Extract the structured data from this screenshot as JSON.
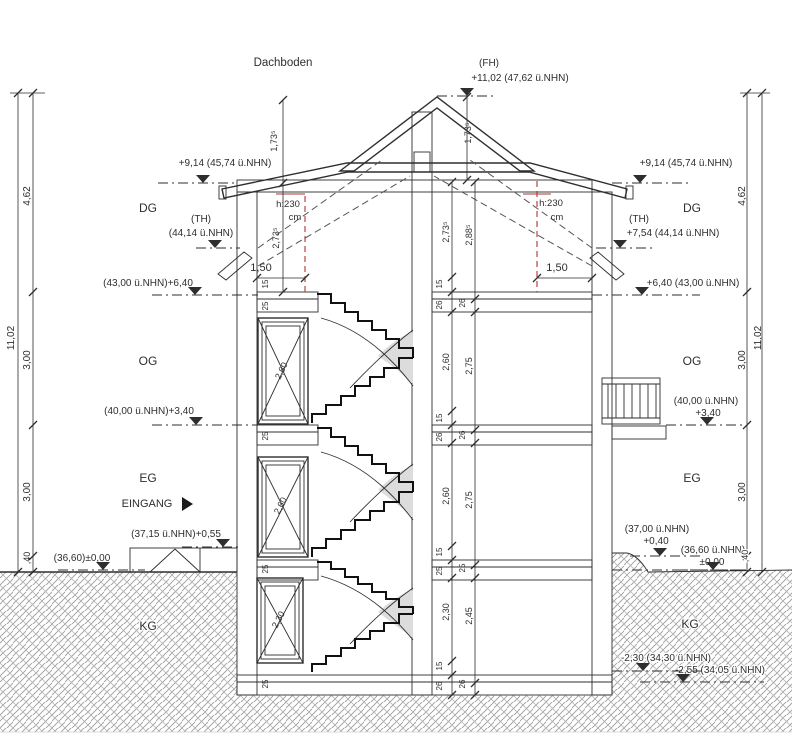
{
  "drawing_title": "Dachboden",
  "colors": {
    "line": "#2e2e2e",
    "red": "#ad3530",
    "stair_shade": "#dcdcdc",
    "hatch": "#909090"
  },
  "story_labels": [
    "DG",
    "OG",
    "EG",
    "KG"
  ],
  "labels": [
    {
      "name": "attic-title",
      "text": "Dachboden",
      "x": 283,
      "y": 66,
      "size": 11.5
    },
    {
      "name": "ridge-fh-tag",
      "text": "(FH)",
      "x": 489,
      "y": 66,
      "size": 10
    },
    {
      "name": "ridge-fh-value",
      "text": "+11,02 (47,62 ü.NHN)",
      "x": 520,
      "y": 81,
      "size": 10
    },
    {
      "name": "eaves-level-left",
      "text": "+9,14 (45,74 ü.NHN)",
      "x": 225,
      "y": 166,
      "size": 10
    },
    {
      "name": "eaves-level-right",
      "text": "+9,14 (45,74 ü.NHN)",
      "x": 686,
      "y": 166,
      "size": 10
    },
    {
      "name": "story-dg-left",
      "text": "DG",
      "x": 148,
      "y": 212,
      "size": 12
    },
    {
      "name": "story-dg-right",
      "text": "DG",
      "x": 692,
      "y": 212,
      "size": 12
    },
    {
      "name": "th-tag-left",
      "text": "(TH)",
      "x": 201,
      "y": 222,
      "size": 10
    },
    {
      "name": "th-value-left",
      "text": "(44,14 ü.NHN)",
      "x": 201,
      "y": 236,
      "size": 10
    },
    {
      "name": "th-tag-right",
      "text": "(TH)",
      "x": 639,
      "y": 222,
      "size": 10
    },
    {
      "name": "th-value-right",
      "text": "+7,54 (44,14 ü.NHN)",
      "x": 673,
      "y": 236,
      "size": 10
    },
    {
      "name": "level-640-left",
      "text": "(43,00 ü.NHN)+6,40",
      "x": 148,
      "y": 286,
      "size": 10
    },
    {
      "name": "level-640-right",
      "text": "+6,40 (43,00 ü.NHN)",
      "x": 693,
      "y": 286,
      "size": 10
    },
    {
      "name": "dim-150-left",
      "text": "1,50",
      "x": 261,
      "y": 271,
      "size": 11
    },
    {
      "name": "dim-150-right",
      "text": "1,50",
      "x": 557,
      "y": 271,
      "size": 11
    },
    {
      "name": "headroom-left-1",
      "text": "h:230",
      "x": 288,
      "y": 207,
      "size": 9.5,
      "color": "red"
    },
    {
      "name": "headroom-left-2",
      "text": "cm",
      "x": 295,
      "y": 220,
      "size": 9.5,
      "color": "red"
    },
    {
      "name": "headroom-right-1",
      "text": "h:230",
      "x": 551,
      "y": 206,
      "size": 9.5,
      "color": "red"
    },
    {
      "name": "headroom-right-2",
      "text": "cm",
      "x": 557,
      "y": 220,
      "size": 9.5,
      "color": "red"
    },
    {
      "name": "story-og-left",
      "text": "OG",
      "x": 148,
      "y": 365,
      "size": 12
    },
    {
      "name": "story-og-right",
      "text": "OG",
      "x": 692,
      "y": 365,
      "size": 12
    },
    {
      "name": "level-340-left",
      "text": "(40,00 ü.NHN)+3,40",
      "x": 149,
      "y": 414,
      "size": 10
    },
    {
      "name": "level-340-right-1",
      "text": "(40,00 ü.NHN)",
      "x": 706,
      "y": 404,
      "size": 10
    },
    {
      "name": "level-340-right-2",
      "text": "+3,40",
      "x": 708,
      "y": 416,
      "size": 10
    },
    {
      "name": "story-eg-left",
      "text": "EG",
      "x": 148,
      "y": 482,
      "size": 12
    },
    {
      "name": "story-eg-right",
      "text": "EG",
      "x": 692,
      "y": 482,
      "size": 12
    },
    {
      "name": "entrance-label",
      "text": "EINGANG",
      "x": 147,
      "y": 507,
      "size": 11
    },
    {
      "name": "level-055",
      "text": "(37,15 ü.NHN)+0,55",
      "x": 176,
      "y": 537,
      "size": 10
    },
    {
      "name": "level-000-left",
      "text": "(36,60)±0,00",
      "x": 82,
      "y": 561,
      "size": 10
    },
    {
      "name": "level-040-right-1",
      "text": "(37,00 ü.NHN)",
      "x": 657,
      "y": 532,
      "size": 10
    },
    {
      "name": "level-040-right-2",
      "text": "+0,40",
      "x": 656,
      "y": 544,
      "size": 10
    },
    {
      "name": "level-000-right-1",
      "text": "(36,60 ü.NHN)",
      "x": 713,
      "y": 553,
      "size": 10,
      "halo": true
    },
    {
      "name": "level-000-right-2",
      "text": "±0,00",
      "x": 712,
      "y": 565,
      "size": 10,
      "halo": true
    },
    {
      "name": "story-kg-left",
      "text": "KG",
      "x": 148,
      "y": 630,
      "size": 12,
      "halo": true
    },
    {
      "name": "story-kg-right",
      "text": "KG",
      "x": 690,
      "y": 628,
      "size": 12,
      "halo": true
    },
    {
      "name": "level-230-kg",
      "text": "-2,30 (34,30 ü.NHN)",
      "x": 666,
      "y": 661,
      "size": 10,
      "halo": true
    },
    {
      "name": "level-255-kg",
      "text": "-2,55 (34,05 ü.NHN)",
      "x": 720,
      "y": 673,
      "size": 10,
      "halo": true
    },
    {
      "name": "dim-total-left",
      "text": "11,02",
      "x": 14,
      "y": 338,
      "size": 10,
      "rot": -90
    },
    {
      "name": "dim-462-left",
      "text": "4,62",
      "x": 30,
      "y": 196,
      "size": 10,
      "rot": -90
    },
    {
      "name": "dim-300-left-og",
      "text": "3,00",
      "x": 30,
      "y": 360,
      "size": 10,
      "rot": -90
    },
    {
      "name": "dim-300-left-eg",
      "text": "3,00",
      "x": 30,
      "y": 492,
      "size": 10,
      "rot": -90
    },
    {
      "name": "dim-40-left",
      "text": ",40",
      "x": 30,
      "y": 558,
      "size": 9,
      "rot": -90
    },
    {
      "name": "dim-total-right",
      "text": "11,02",
      "x": 761,
      "y": 338,
      "size": 10,
      "rot": -90
    },
    {
      "name": "dim-462-right",
      "text": "4,62",
      "x": 745,
      "y": 196,
      "size": 10,
      "rot": -90
    },
    {
      "name": "dim-300-right-og",
      "text": "3,00",
      "x": 745,
      "y": 360,
      "size": 10,
      "rot": -90
    },
    {
      "name": "dim-300-right-eg",
      "text": "3,00",
      "x": 745,
      "y": 492,
      "size": 10,
      "rot": -90
    },
    {
      "name": "dim-40-right",
      "text": ",40",
      "x": 748,
      "y": 556,
      "size": 9,
      "rot": -90,
      "halo": true
    },
    {
      "name": "dim-173-left",
      "text": "1,73⁵",
      "x": 277,
      "y": 141,
      "size": 9,
      "rot": -90
    },
    {
      "name": "dim-173-right",
      "text": "1,73⁵",
      "x": 471,
      "y": 133,
      "size": 9,
      "rot": -90
    },
    {
      "name": "dim-273-left",
      "text": "2,73⁵",
      "x": 279,
      "y": 238,
      "size": 9,
      "rot": -90
    },
    {
      "name": "dim-273-mid",
      "text": "2,73⁵",
      "x": 449,
      "y": 232,
      "size": 9,
      "rot": -90
    },
    {
      "name": "dim-288-mid",
      "text": "2,88⁵",
      "x": 472,
      "y": 235,
      "size": 9,
      "rot": -90
    },
    {
      "name": "dim-260-og",
      "text": "2,60",
      "x": 449,
      "y": 362,
      "size": 9,
      "rot": -90
    },
    {
      "name": "dim-275-og",
      "text": "2,75",
      "x": 472,
      "y": 366,
      "size": 9,
      "rot": -90
    },
    {
      "name": "dim-260-eg",
      "text": "2,60",
      "x": 449,
      "y": 496,
      "size": 9,
      "rot": -90
    },
    {
      "name": "dim-275-eg",
      "text": "2,75",
      "x": 472,
      "y": 500,
      "size": 9,
      "rot": -90
    },
    {
      "name": "dim-230-kg",
      "text": "2,30",
      "x": 449,
      "y": 612,
      "size": 9,
      "rot": -90
    },
    {
      "name": "dim-245-kg",
      "text": "2,45",
      "x": 472,
      "y": 616,
      "size": 9,
      "rot": -90
    },
    {
      "name": "slab-dg-15",
      "text": "15",
      "x": 442,
      "y": 284,
      "size": 8,
      "rot": -90
    },
    {
      "name": "slab-dg-26a",
      "text": "26",
      "x": 442,
      "y": 305,
      "size": 8,
      "rot": -90
    },
    {
      "name": "slab-dg-26b",
      "text": "26",
      "x": 465,
      "y": 303,
      "size": 8,
      "rot": -90
    },
    {
      "name": "slab-dg-15w",
      "text": "15",
      "x": 268,
      "y": 284,
      "size": 8,
      "rot": -90
    },
    {
      "name": "slab-dg-25w",
      "text": "25",
      "x": 268,
      "y": 306,
      "size": 8,
      "rot": -90
    },
    {
      "name": "slab-og-15",
      "text": "15",
      "x": 442,
      "y": 418,
      "size": 8,
      "rot": -90
    },
    {
      "name": "slab-og-26a",
      "text": "26",
      "x": 442,
      "y": 437,
      "size": 8,
      "rot": -90
    },
    {
      "name": "slab-og-26b",
      "text": "26",
      "x": 465,
      "y": 435,
      "size": 8,
      "rot": -90
    },
    {
      "name": "slab-og-25w",
      "text": "25",
      "x": 268,
      "y": 436,
      "size": 8,
      "rot": -90
    },
    {
      "name": "slab-eg-15",
      "text": "15",
      "x": 442,
      "y": 552,
      "size": 8,
      "rot": -90
    },
    {
      "name": "slab-eg-25a",
      "text": "25",
      "x": 442,
      "y": 571,
      "size": 8,
      "rot": -90
    },
    {
      "name": "slab-eg-25b",
      "text": "25",
      "x": 465,
      "y": 568,
      "size": 8,
      "rot": -90
    },
    {
      "name": "slab-eg-25w",
      "text": "25",
      "x": 268,
      "y": 569,
      "size": 8,
      "rot": -90
    },
    {
      "name": "slab-kg-15",
      "text": "15",
      "x": 442,
      "y": 666,
      "size": 8,
      "rot": -90
    },
    {
      "name": "slab-kg-26a",
      "text": "26",
      "x": 442,
      "y": 686,
      "size": 8,
      "rot": -90
    },
    {
      "name": "slab-kg-26b",
      "text": "26",
      "x": 465,
      "y": 684,
      "size": 8,
      "rot": -90
    },
    {
      "name": "slab-kg-25w",
      "text": "25",
      "x": 268,
      "y": 684,
      "size": 8,
      "rot": -90
    },
    {
      "name": "window-og-height",
      "text": "2,60",
      "x": 284,
      "y": 372,
      "size": 9,
      "rot": -64
    },
    {
      "name": "window-eg-height",
      "text": "2,60",
      "x": 283,
      "y": 507,
      "size": 9,
      "rot": -63
    },
    {
      "name": "window-kg-height",
      "text": "2,30",
      "x": 281,
      "y": 621,
      "size": 9,
      "rot": -62
    }
  ],
  "level_markers": [
    {
      "name": "marker-fh",
      "x": 467,
      "y": 88,
      "lx1": 437,
      "lx2": 497,
      "ly": 96
    },
    {
      "name": "marker-eaves-left",
      "x": 203,
      "y": 175,
      "lx1": 158,
      "lx2": 237,
      "ly": 183
    },
    {
      "name": "marker-eaves-right",
      "x": 640,
      "y": 175,
      "lx1": 612,
      "lx2": 688,
      "ly": 183
    },
    {
      "name": "marker-th-left",
      "x": 215,
      "y": 240,
      "lx1": 196,
      "lx2": 240,
      "ly": 248
    },
    {
      "name": "marker-th-right",
      "x": 620,
      "y": 240,
      "lx1": 596,
      "lx2": 652,
      "ly": 248
    },
    {
      "name": "marker-640-left",
      "x": 195,
      "y": 287,
      "lx1": 152,
      "lx2": 258,
      "ly": 295
    },
    {
      "name": "marker-640-right",
      "x": 642,
      "y": 287,
      "lx1": 592,
      "lx2": 700,
      "ly": 295
    },
    {
      "name": "marker-340-left",
      "x": 196,
      "y": 417,
      "lx1": 152,
      "lx2": 258,
      "ly": 425
    },
    {
      "name": "marker-340-right",
      "x": 707,
      "y": 417,
      "lx1": 666,
      "lx2": 744,
      "ly": 425
    },
    {
      "name": "marker-055",
      "x": 223,
      "y": 539,
      "lx1": 182,
      "lx2": 240,
      "ly": 547
    },
    {
      "name": "marker-000-left",
      "x": 103,
      "y": 562,
      "lx1": 58,
      "lx2": 145,
      "ly": 570
    },
    {
      "name": "marker-040-right",
      "x": 660,
      "y": 548,
      "lx1": 630,
      "lx2": 700,
      "ly": 556
    },
    {
      "name": "marker-000-right",
      "x": 713,
      "y": 562,
      "lx1": 676,
      "lx2": 746,
      "ly": 570
    },
    {
      "name": "marker-230",
      "x": 643,
      "y": 663,
      "lx1": 612,
      "lx2": 705,
      "ly": 671
    },
    {
      "name": "marker-255",
      "x": 683,
      "y": 674,
      "lx1": 640,
      "lx2": 764,
      "ly": 682
    }
  ]
}
